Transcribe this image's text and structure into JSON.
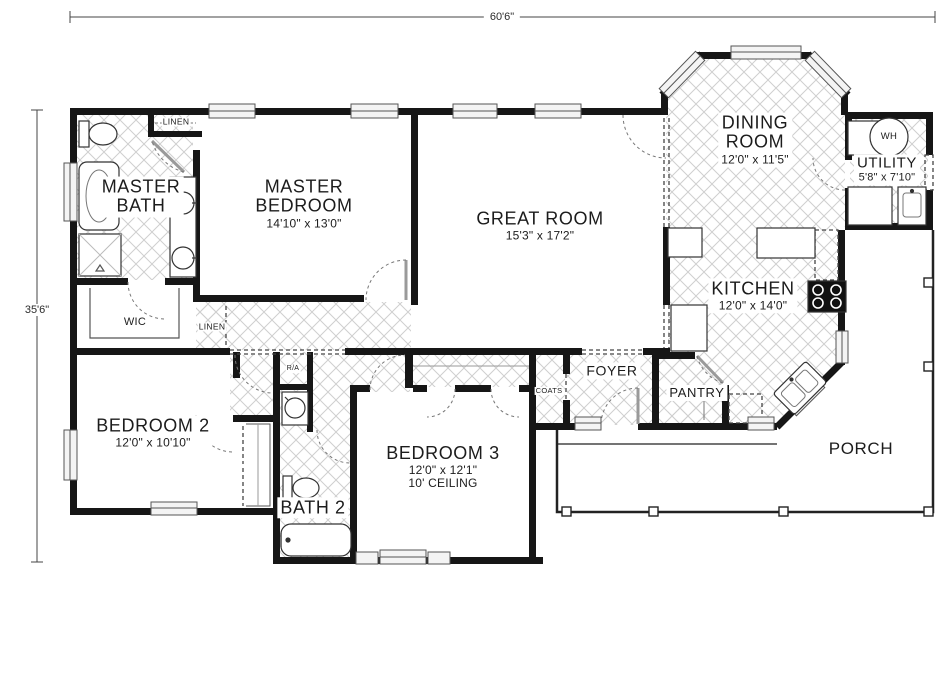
{
  "dimensions": {
    "overall_width": "60'6\"",
    "overall_height": "35'6\""
  },
  "rooms": {
    "master_bath": {
      "line1": "MASTER",
      "line2": "BATH"
    },
    "master_bedroom": {
      "line1": "MASTER",
      "line2": "BEDROOM",
      "dims": "14'10\" x 13'0\""
    },
    "great_room": {
      "line1": "GREAT ROOM",
      "dims": "15'3\" x 17'2\""
    },
    "dining_room": {
      "line1": "DINING",
      "line2": "ROOM",
      "dims": "12'0\" x 11'5\""
    },
    "kitchen": {
      "line1": "KITCHEN",
      "dims": "12'0\" x 14'0\""
    },
    "utility": {
      "line1": "UTILITY",
      "dims": "5'8\" x 7'10\""
    },
    "bedroom2": {
      "line1": "BEDROOM 2",
      "dims": "12'0\" x 10'10\""
    },
    "bedroom3": {
      "line1": "BEDROOM 3",
      "dims": "12'0\" x 12'1\"",
      "extra": "10' CEILING"
    },
    "bath2": {
      "line1": "BATH 2"
    },
    "foyer": {
      "line1": "FOYER"
    },
    "porch": {
      "line1": "PORCH"
    },
    "pantry": {
      "line1": "PANTRY"
    },
    "wic": {
      "line1": "WIC"
    },
    "coats": {
      "line1": "COATS"
    },
    "linen_bath": {
      "line1": "LINEN"
    },
    "linen_hall": {
      "line1": "LINEN"
    },
    "return_air": {
      "line1": "R/A"
    },
    "water_heater": {
      "line1": "WH"
    }
  }
}
